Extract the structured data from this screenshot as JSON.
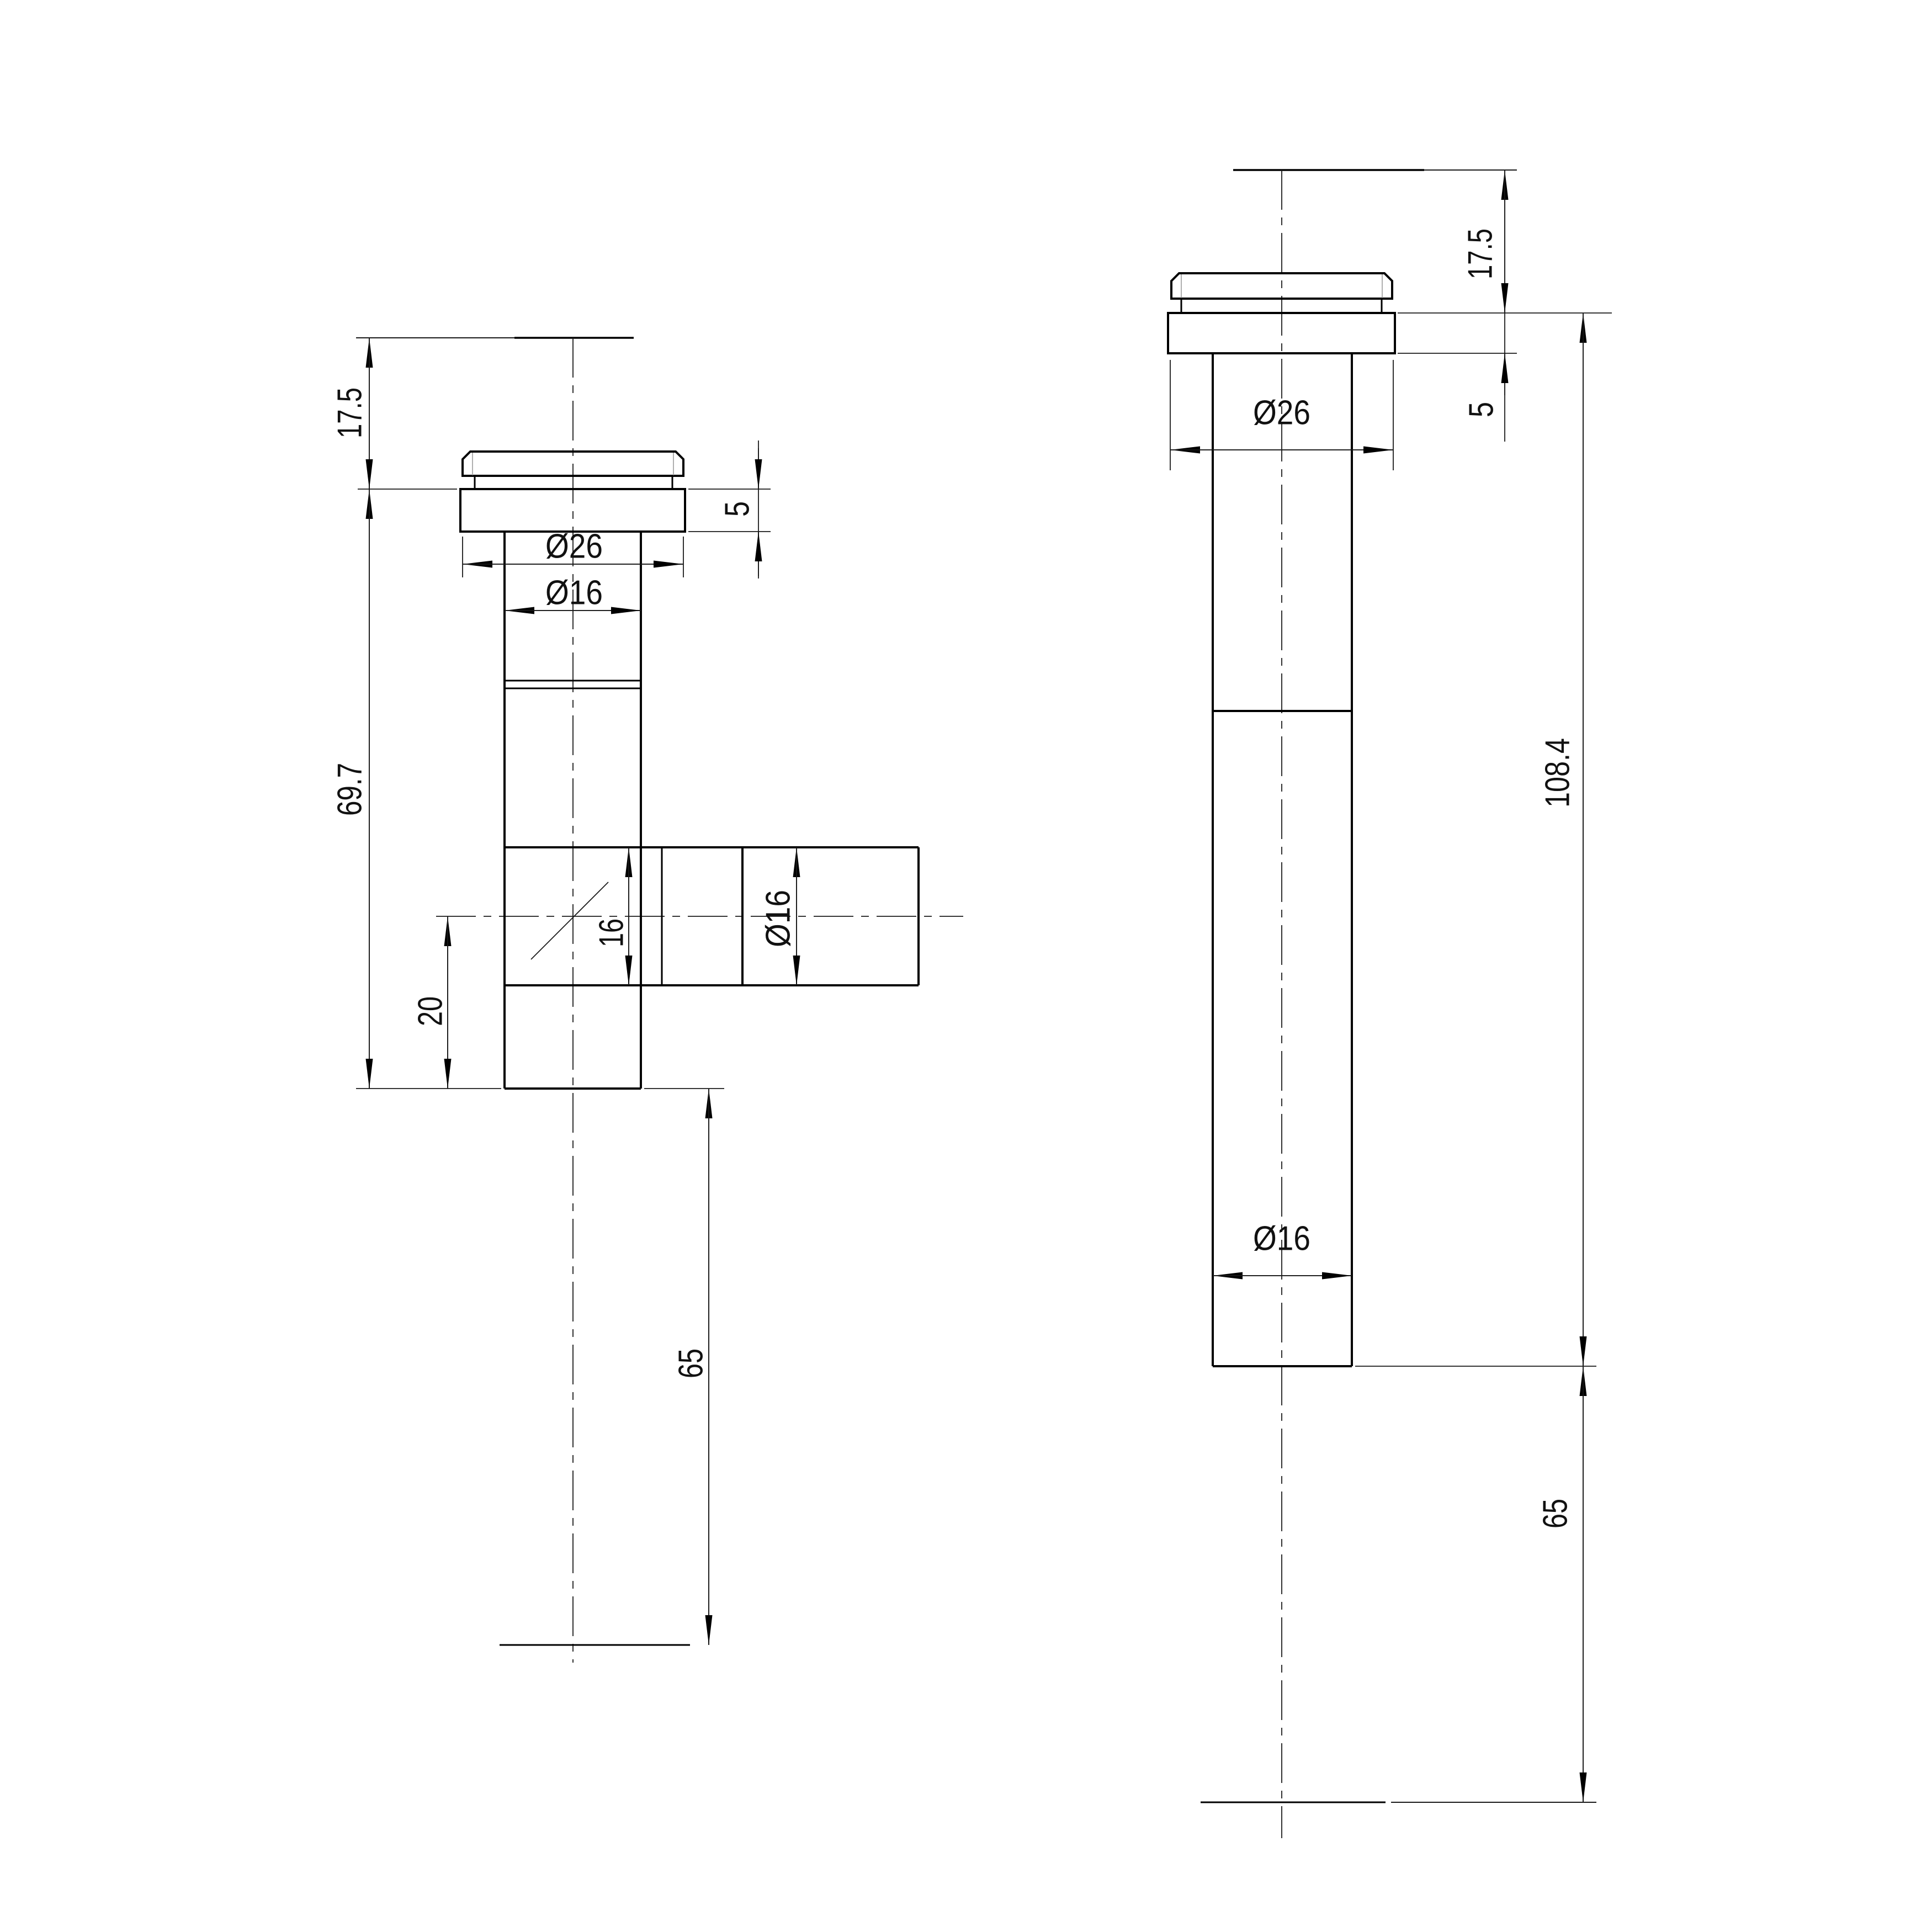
{
  "document": {
    "type": "technical-drawing",
    "background_color": "#ffffff",
    "line_color": "#000000",
    "chamfer_line_color": "#9b9b9b",
    "units_shown": "mm"
  },
  "views": {
    "front": {
      "name": "front view with side outlet (T-shaped fitting)",
      "dims": {
        "cap_height": "17.5",
        "flange_height": "5",
        "flange_diameter": "Ø26",
        "tube_diameter": "Ø16",
        "body_length": "69.7",
        "branch_bore": "16",
        "branch_diameter": "Ø16",
        "branch_to_end": "20",
        "tail_extension": "65"
      }
    },
    "side": {
      "name": "side view (straight tube)",
      "dims": {
        "cap_height": "17.5",
        "flange_height": "5",
        "flange_diameter": "Ø26",
        "overall_length": "108.4",
        "tube_diameter": "Ø16",
        "tail_extension": "65"
      }
    }
  }
}
